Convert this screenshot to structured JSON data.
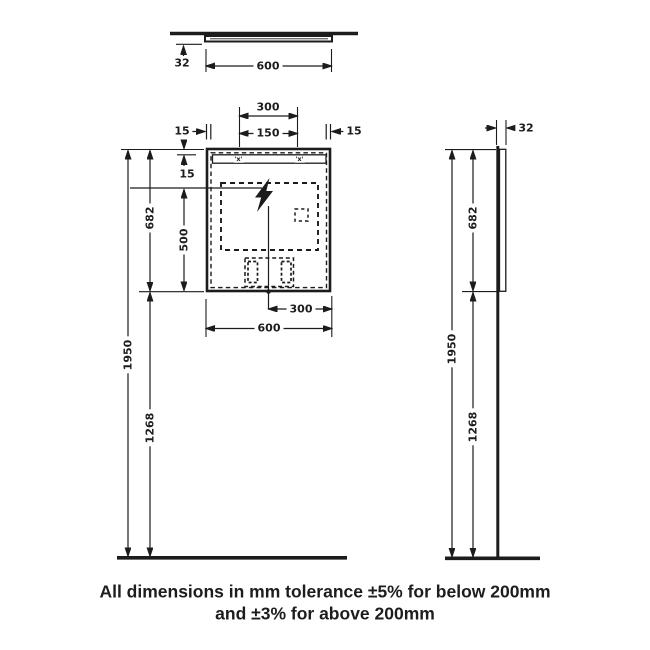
{
  "caption": {
    "line1": "All dimensions in mm tolerance ±5% for below 200mm",
    "line2": "and ±3% for above 200mm"
  },
  "top_view": {
    "thickness": "32",
    "width": "600"
  },
  "front_view": {
    "fixing_span": "300",
    "fixing_half": "150",
    "inset_left": "15",
    "inset_right": "15",
    "strip_offset": "15",
    "mirror_height": "682",
    "zone_height": "500",
    "overall_height": "1950",
    "bottom_clearance": "1268",
    "center_offset": "300",
    "width": "600",
    "fixing_mark": "'x'"
  },
  "side_view": {
    "depth": "32",
    "mirror_height": "682",
    "overall_height": "1950",
    "bottom_clearance": "1268"
  },
  "colors": {
    "line": "#1c1c1c",
    "background": "#ffffff"
  }
}
